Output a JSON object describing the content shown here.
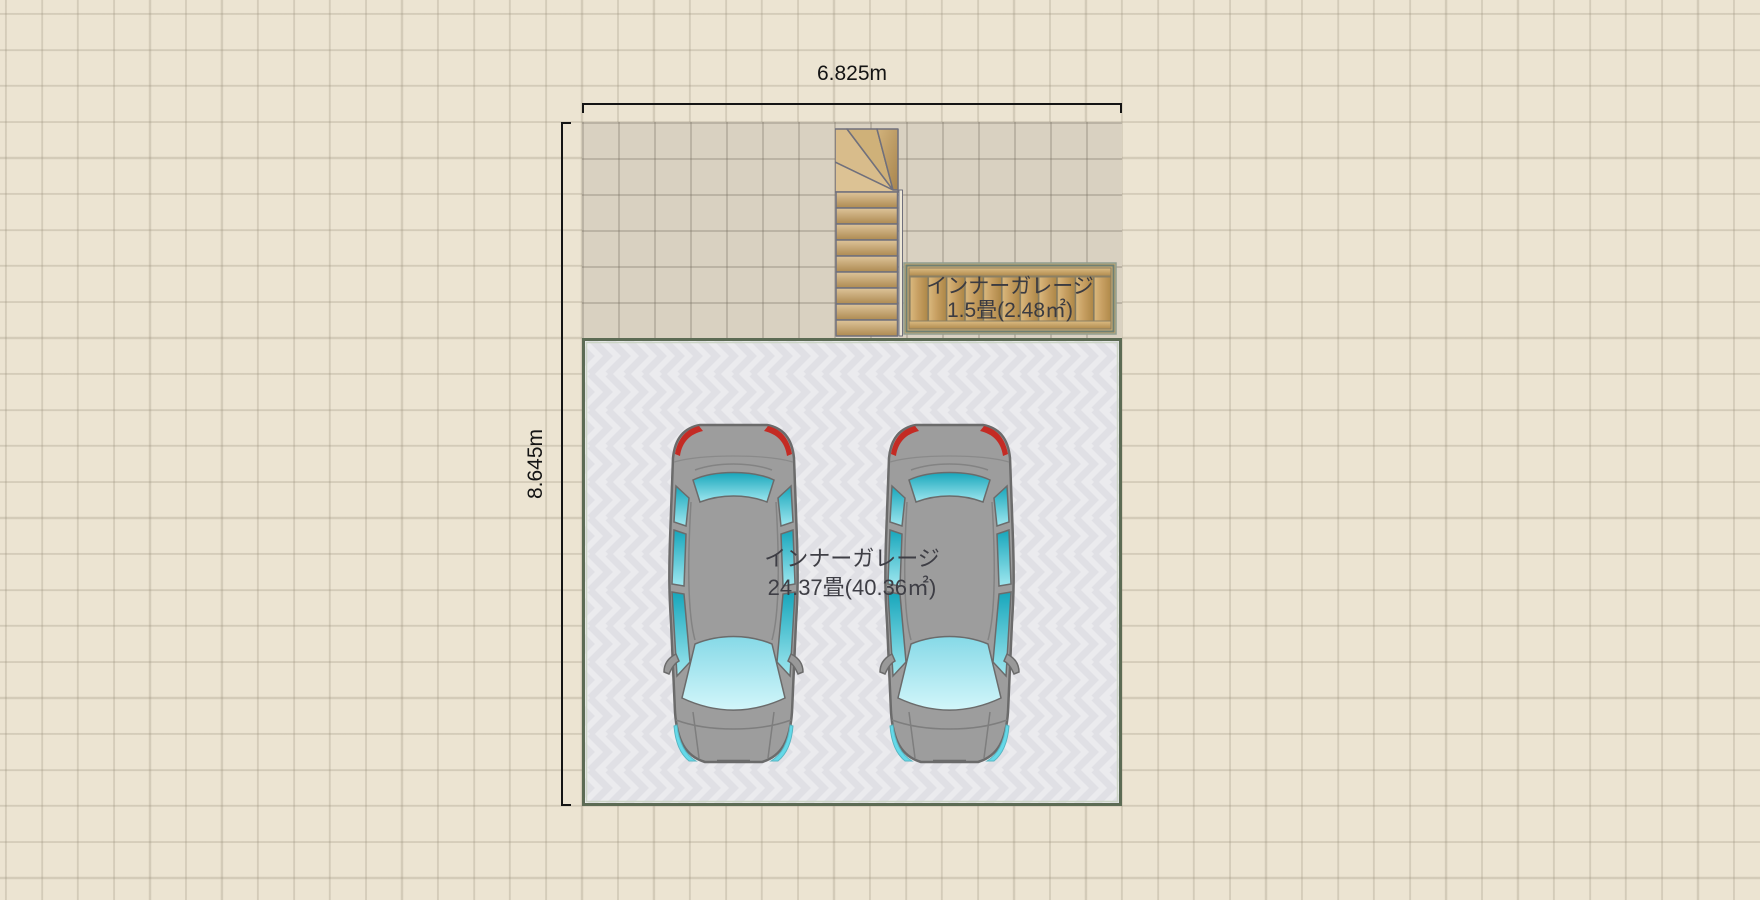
{
  "floorplan": {
    "dimensions": {
      "width": "6.825m",
      "height": "8.645m"
    },
    "rooms": {
      "inner_garage_small": {
        "name": "インナーガレージ",
        "area": "1.5畳(2.48㎡)"
      },
      "inner_garage_large": {
        "name": "インナーガレージ",
        "area": "24.37畳(40.36㎡)"
      }
    },
    "objects": {
      "staircase_count": 1,
      "car_count": 2
    },
    "colors": {
      "canvas_bg": "#ece4d2",
      "plan_fill": "#d9d1c1",
      "garage_floor": "#ebebee",
      "garage_border": "#5c6b54",
      "wood_deck": "#cdad73",
      "stair_tread": "#d8bc8b",
      "car_body": "#9d9d9d",
      "window_teal": "#2ab5c8",
      "taillight_red": "#c42b24",
      "dimension_ink": "#141414"
    }
  }
}
